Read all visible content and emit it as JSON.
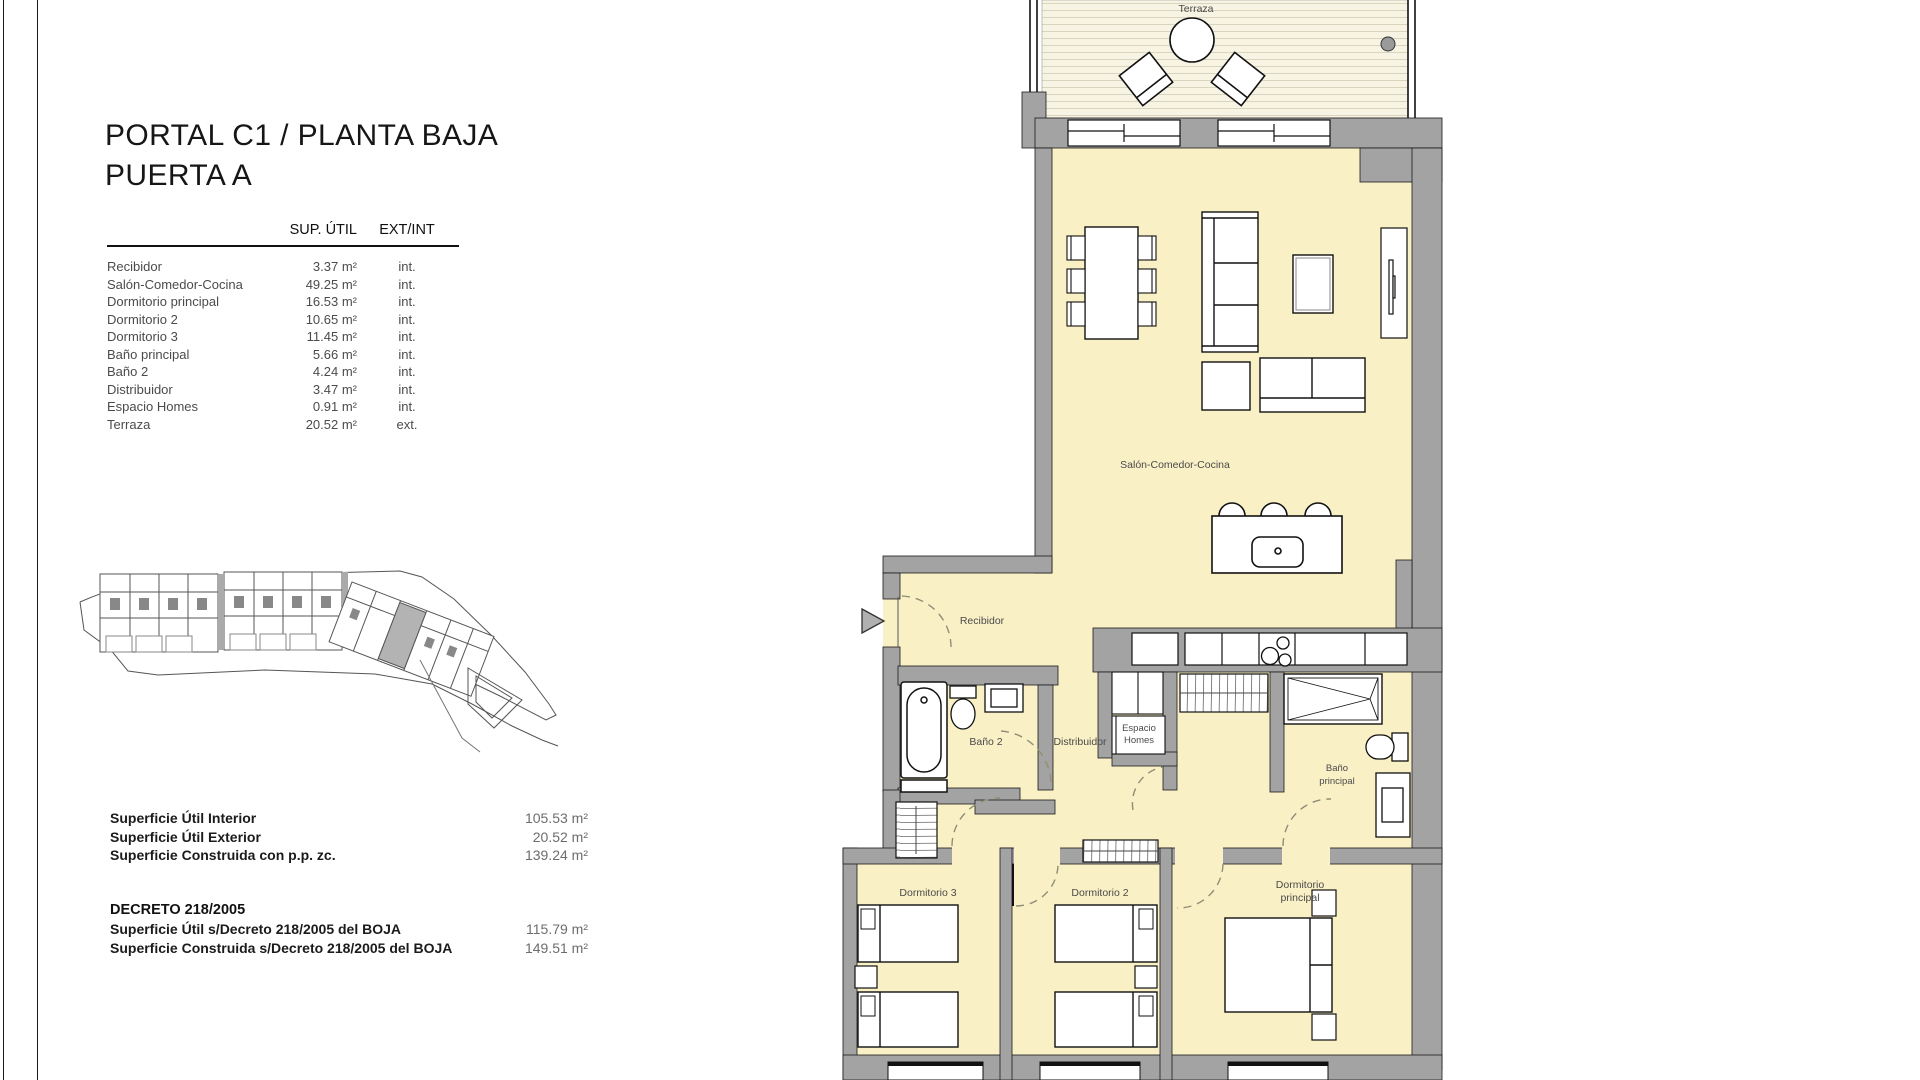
{
  "header": {
    "title_line1": "PORTAL C1 / PLANTA BAJA",
    "title_line2": "PUERTA A"
  },
  "areas_table": {
    "col_sup": "SUP. ÚTIL",
    "col_extint": "EXT/INT",
    "rows": [
      {
        "name": "Recibidor",
        "sup": "3.37 m²",
        "ext": "int."
      },
      {
        "name": "Salón-Comedor-Cocina",
        "sup": "49.25 m²",
        "ext": "int."
      },
      {
        "name": "Dormitorio principal",
        "sup": "16.53 m²",
        "ext": "int."
      },
      {
        "name": "Dormitorio 2",
        "sup": "10.65 m²",
        "ext": "int."
      },
      {
        "name": "Dormitorio 3",
        "sup": "11.45 m²",
        "ext": "int."
      },
      {
        "name": "Baño principal",
        "sup": "5.66 m²",
        "ext": "int."
      },
      {
        "name": "Baño 2",
        "sup": "4.24 m²",
        "ext": "int."
      },
      {
        "name": "Distribuidor",
        "sup": "3.47 m²",
        "ext": "int."
      },
      {
        "name": "Espacio Homes",
        "sup": "0.91 m²",
        "ext": "int."
      },
      {
        "name": "Terraza",
        "sup": "20.52 m²",
        "ext": "ext."
      }
    ]
  },
  "summary": {
    "rows": [
      {
        "label": "Superficie Útil Interior",
        "value": "105.53 m²"
      },
      {
        "label": "Superficie Útil Exterior",
        "value": "20.52 m²"
      },
      {
        "label": "Superficie Construida con p.p. zc.",
        "value": "139.24 m²"
      }
    ]
  },
  "decreto": {
    "heading": "DECRETO 218/2005",
    "rows": [
      {
        "label": "Superficie Útil s/Decreto 218/2005 del BOJA",
        "value": "115.79 m²"
      },
      {
        "label": "Superficie Construida s/Decreto 218/2005 del BOJA",
        "value": "149.51 m²"
      }
    ]
  },
  "plan": {
    "labels": {
      "terraza": "Terraza",
      "salon": "Salón-Comedor-Cocina",
      "recibidor": "Recibidor",
      "bano2": "Baño 2",
      "distribuidor": "Distribuidor",
      "espacio_line1": "Espacio",
      "espacio_line2": "Homes",
      "bano_ppal_line1": "Baño",
      "bano_ppal_line2": "principal",
      "dorm3": "Dormitorio 3",
      "dorm2": "Dormitorio 2",
      "dorm_ppal_line1": "Dormitorio",
      "dorm_ppal_line2": "principal"
    }
  },
  "colors": {
    "floor": "#FAF0C6",
    "wall": "#A3A3A3",
    "deck": "#F7F4E4",
    "deck_line": "#D8D4BE",
    "door_arc": "#8F8F75"
  }
}
